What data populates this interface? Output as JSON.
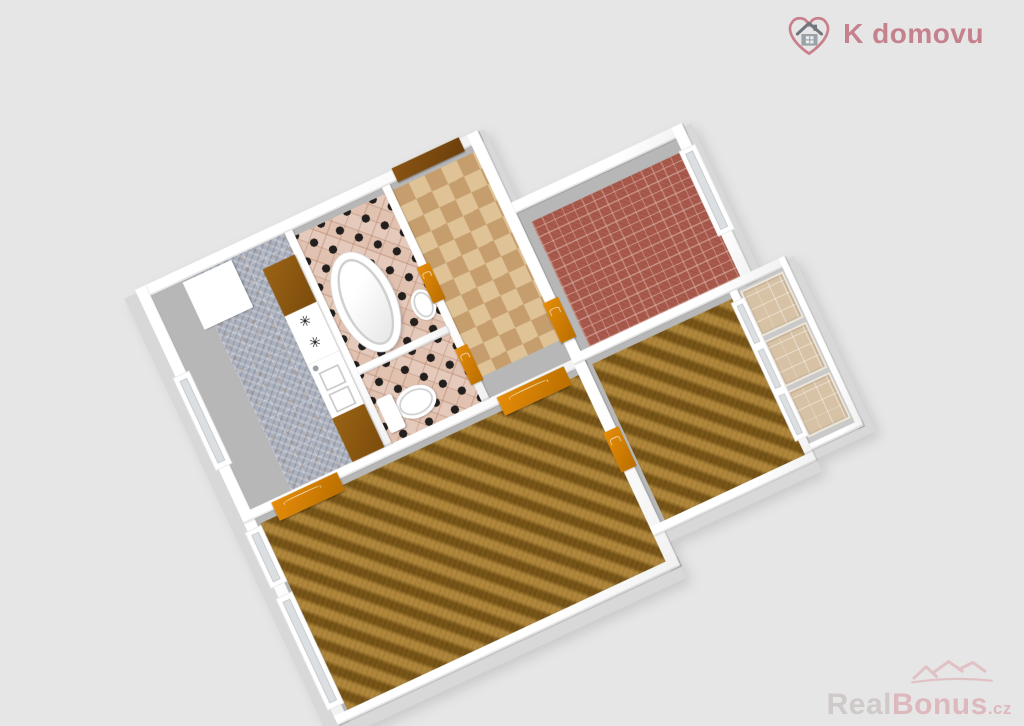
{
  "brand": {
    "logo_text": "K domovu",
    "logo_color": "#c5818c",
    "icon": "heart-with-house-icon"
  },
  "watermark": {
    "real": "Real",
    "bonus": "Bonus",
    "tld": ".cz",
    "color": "#dcb0b5",
    "icon": "rooftops-icon"
  },
  "floorplan": {
    "type": "3d-apartment-floor-plan",
    "background_color": "#e6e6e6",
    "wall_color": "#ffffff",
    "burner_glyph": "✳",
    "rooms": [
      {
        "id": "kitchen",
        "floor_style": "gray-marble-tiles",
        "floor_color": "#abb0bd",
        "fixtures": [
          "fridge",
          "counter-cabinet",
          "cooktop",
          "sink-cabinet",
          "counter-cabinet"
        ]
      },
      {
        "id": "bathroom",
        "floor_style": "diagonal-checker-tiles",
        "floor_color": "#e5cabb",
        "accent_color": "#221f1d",
        "fixtures": [
          "bathtub",
          "washbasin"
        ]
      },
      {
        "id": "wc",
        "floor_style": "diagonal-checker-tiles",
        "floor_color": "#e5cabb",
        "accent_color": "#221f1d",
        "fixtures": [
          "toilet"
        ]
      },
      {
        "id": "hallway",
        "floor_style": "beige-checker-tiles",
        "floor_color": "#d2ad7f",
        "fixtures": []
      },
      {
        "id": "red-room",
        "floor_style": "red-brick-carpet",
        "floor_color": "#a95a4c",
        "fixtures": []
      },
      {
        "id": "living-room",
        "floor_style": "brown-weave-carpet",
        "floor_color": "#91691f",
        "fixtures": []
      },
      {
        "id": "bedroom",
        "floor_style": "brown-weave-carpet",
        "floor_color": "#91691f",
        "fixtures": []
      },
      {
        "id": "balcony",
        "floor_style": "beige-tile-panels",
        "floor_color": "#d7c2a5",
        "fixtures": []
      }
    ],
    "doors": {
      "entrance_color": "#6b3f0a",
      "interior_color": "#d07c04"
    },
    "window_color": "#ffffff"
  }
}
